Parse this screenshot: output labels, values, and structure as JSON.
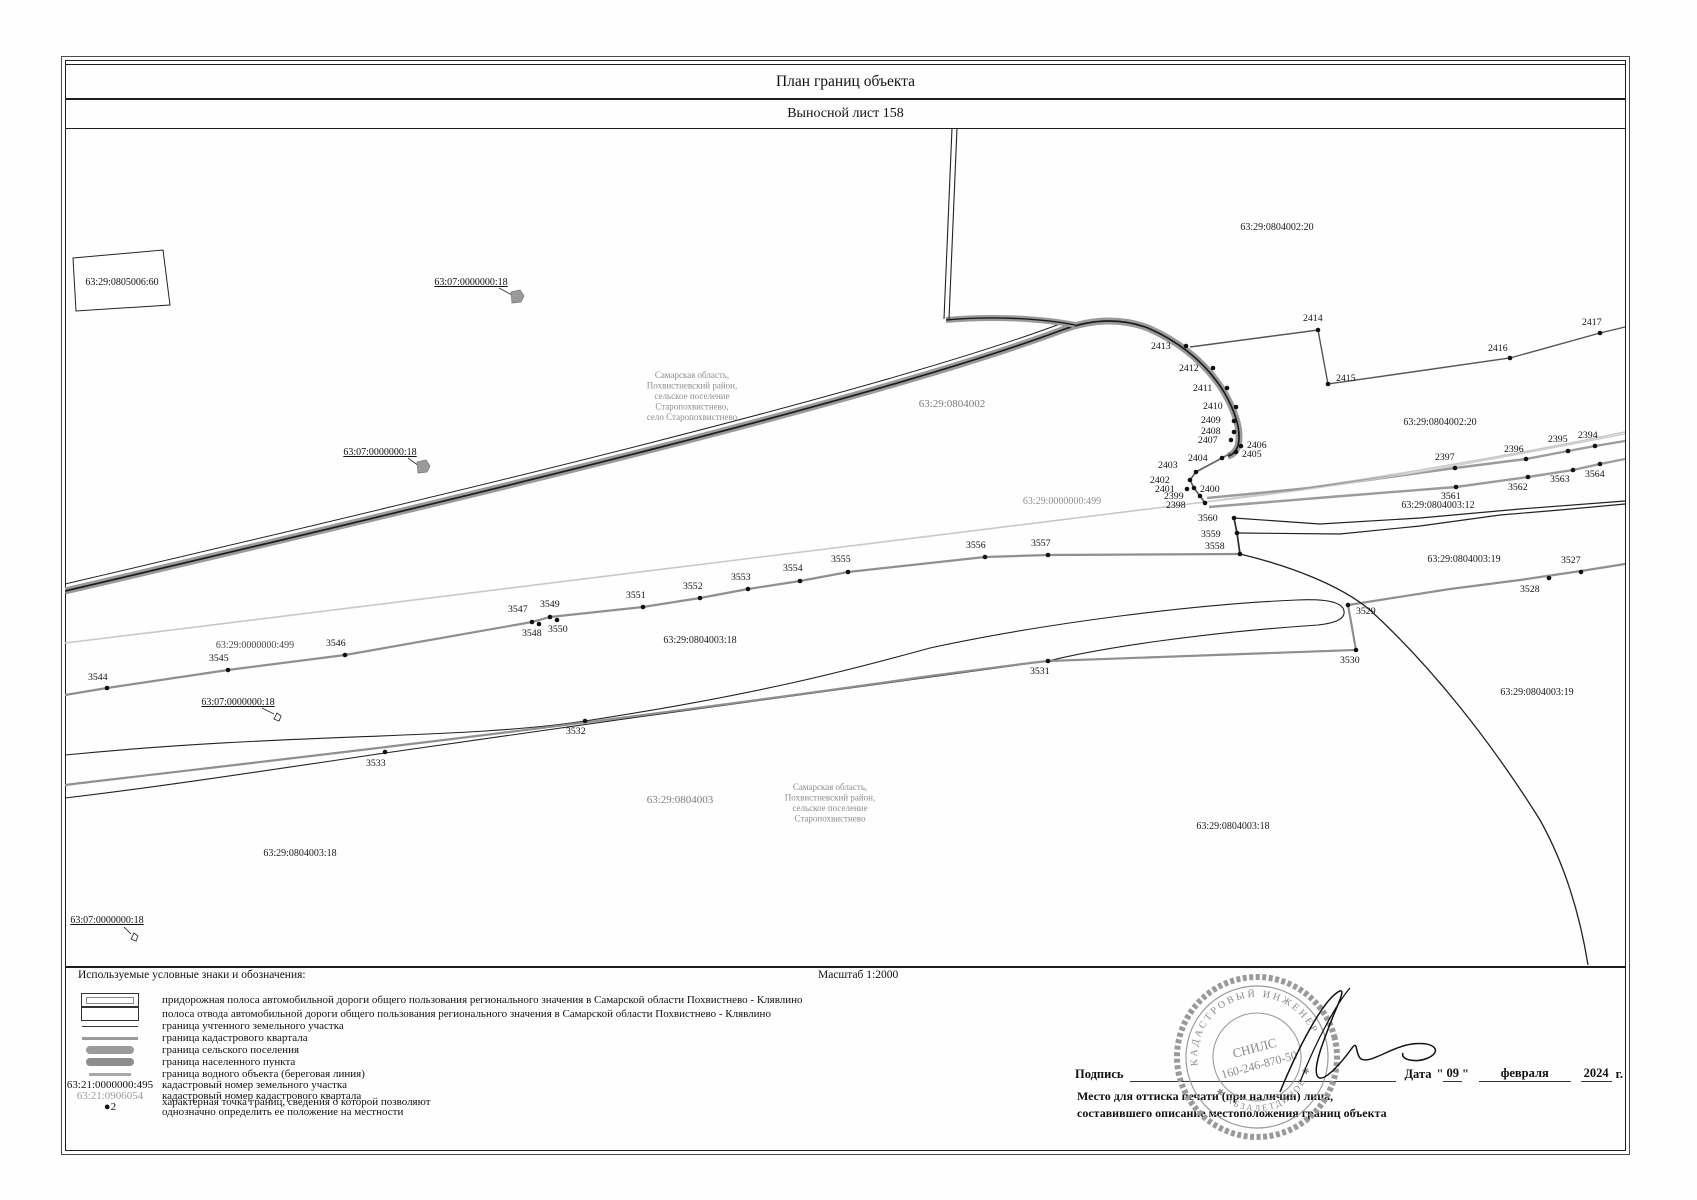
{
  "header": {
    "title": "План границ объекта",
    "subtitle": "Выносной лист 158"
  },
  "map": {
    "labels": [
      {
        "t": "63:29:0805006:60",
        "x": 122,
        "y": 285,
        "c": "#111111",
        "fs": 10
      },
      {
        "t": "63:07:0000000:18",
        "x": 471,
        "y": 285,
        "c": "#111111",
        "fs": 10,
        "ul": 1
      },
      {
        "t": "63:07:0000000:18",
        "x": 380,
        "y": 455,
        "c": "#111111",
        "fs": 10,
        "ul": 1
      },
      {
        "t": "63:07:0000000:18",
        "x": 238,
        "y": 705,
        "c": "#111111",
        "fs": 10,
        "ul": 1
      },
      {
        "t": "63:07:0000000:18",
        "x": 107,
        "y": 923,
        "c": "#111111",
        "fs": 10,
        "ul": 1
      },
      {
        "lines": [
          "Самарская область,",
          "Похвистневский район,",
          "сельское поселение",
          "Старопохвистнево,",
          "село Старопохвистнево"
        ],
        "x": 692,
        "y": 378,
        "c": "#8e8e8e",
        "fs": 9
      },
      {
        "t": "63:29:0804002",
        "x": 952,
        "y": 407,
        "c": "#7d7d7d",
        "fs": 11
      },
      {
        "t": "63:29:0804002:20",
        "x": 1277,
        "y": 230,
        "c": "#1a1a1a",
        "fs": 10
      },
      {
        "t": "63:29:0804002:20",
        "x": 1440,
        "y": 425,
        "c": "#1a1a1a",
        "fs": 10
      },
      {
        "t": "63:29:0000000:499",
        "x": 1062,
        "y": 504,
        "c": "#8e8e8e",
        "fs": 10
      },
      {
        "t": "63:29:0000000:499",
        "x": 255,
        "y": 648,
        "c": "#4a4a4a",
        "fs": 10
      },
      {
        "t": "63:29:0804003:18",
        "x": 700,
        "y": 643,
        "c": "#1a1a1a",
        "fs": 10
      },
      {
        "t": "63:29:0804003:12",
        "x": 1438,
        "y": 508,
        "c": "#1a1a1a",
        "fs": 10
      },
      {
        "t": "63:29:0804003:19",
        "x": 1464,
        "y": 562,
        "c": "#1a1a1a",
        "fs": 10
      },
      {
        "t": "63:29:0804003:19",
        "x": 1537,
        "y": 695,
        "c": "#1a1a1a",
        "fs": 10
      },
      {
        "t": "63:29:0804003",
        "x": 680,
        "y": 803,
        "c": "#7d7d7d",
        "fs": 11
      },
      {
        "lines": [
          "Самарская область,",
          "Похвистневский район,",
          "сельское поселение",
          "Старопохвистнево"
        ],
        "x": 830,
        "y": 790,
        "c": "#8e8e8e",
        "fs": 9
      },
      {
        "t": "63:29:0804003:18",
        "x": 1233,
        "y": 829,
        "c": "#1a1a1a",
        "fs": 10
      },
      {
        "t": "63:29:0804003:18",
        "x": 300,
        "y": 856,
        "c": "#1a1a1a",
        "fs": 10
      }
    ],
    "points": [
      {
        "n": "2394",
        "x": 1595,
        "y": 446,
        "lx": 1578,
        "ly": 438
      },
      {
        "n": "2395",
        "x": 1568,
        "y": 451,
        "lx": 1548,
        "ly": 442
      },
      {
        "n": "2396",
        "x": 1526,
        "y": 459,
        "lx": 1504,
        "ly": 452
      },
      {
        "n": "2397",
        "x": 1455,
        "y": 468,
        "lx": 1435,
        "ly": 460
      },
      {
        "n": "2398",
        "x": 1205,
        "y": 503,
        "lx": 1166,
        "ly": 508
      },
      {
        "n": "2399",
        "x": 1200,
        "y": 496,
        "lx": 1164,
        "ly": 499
      },
      {
        "n": "2400",
        "x": 1194,
        "y": 488,
        "lx": 1200,
        "ly": 492
      },
      {
        "n": "2401",
        "x": 1187,
        "y": 489,
        "lx": 1155,
        "ly": 492
      },
      {
        "n": "2402",
        "x": 1190,
        "y": 480,
        "lx": 1150,
        "ly": 483
      },
      {
        "n": "2403",
        "x": 1196,
        "y": 472,
        "lx": 1158,
        "ly": 468
      },
      {
        "n": "2404",
        "x": 1222,
        "y": 458,
        "lx": 1188,
        "ly": 461
      },
      {
        "n": "2405",
        "x": 1236,
        "y": 452,
        "lx": 1242,
        "ly": 457
      },
      {
        "n": "2406",
        "x": 1241,
        "y": 446,
        "lx": 1247,
        "ly": 448
      },
      {
        "n": "2407",
        "x": 1231,
        "y": 440,
        "lx": 1198,
        "ly": 443
      },
      {
        "n": "2408",
        "x": 1234,
        "y": 432,
        "lx": 1201,
        "ly": 434
      },
      {
        "n": "2409",
        "x": 1234,
        "y": 421,
        "lx": 1201,
        "ly": 423
      },
      {
        "n": "2410",
        "x": 1236,
        "y": 407,
        "lx": 1203,
        "ly": 409
      },
      {
        "n": "2411",
        "x": 1227,
        "y": 388,
        "lx": 1193,
        "ly": 391
      },
      {
        "n": "2412",
        "x": 1213,
        "y": 368,
        "lx": 1179,
        "ly": 371
      },
      {
        "n": "2413",
        "x": 1186,
        "y": 346,
        "lx": 1151,
        "ly": 349
      },
      {
        "n": "2414",
        "x": 1318,
        "y": 330,
        "lx": 1303,
        "ly": 321
      },
      {
        "n": "2415",
        "x": 1328,
        "y": 384,
        "lx": 1336,
        "ly": 381
      },
      {
        "n": "2416",
        "x": 1510,
        "y": 358,
        "lx": 1488,
        "ly": 351
      },
      {
        "n": "2417",
        "x": 1600,
        "y": 333,
        "lx": 1582,
        "ly": 325
      },
      {
        "n": "3527",
        "x": 1581,
        "y": 572,
        "lx": 1561,
        "ly": 563
      },
      {
        "n": "3528",
        "x": 1549,
        "y": 578,
        "lx": 1520,
        "ly": 592
      },
      {
        "n": "3529",
        "x": 1348,
        "y": 605,
        "lx": 1356,
        "ly": 614
      },
      {
        "n": "3530",
        "x": 1356,
        "y": 650,
        "lx": 1340,
        "ly": 663
      },
      {
        "n": "3531",
        "x": 1048,
        "y": 661,
        "lx": 1030,
        "ly": 674
      },
      {
        "n": "3532",
        "x": 585,
        "y": 721,
        "lx": 566,
        "ly": 734
      },
      {
        "n": "3533",
        "x": 385,
        "y": 752,
        "lx": 366,
        "ly": 766
      },
      {
        "n": "3544",
        "x": 107,
        "y": 688,
        "lx": 88,
        "ly": 680
      },
      {
        "n": "3545",
        "x": 228,
        "y": 670,
        "lx": 209,
        "ly": 661
      },
      {
        "n": "3546",
        "x": 345,
        "y": 655,
        "lx": 326,
        "ly": 646
      },
      {
        "n": "3547",
        "x": 532,
        "y": 622,
        "lx": 508,
        "ly": 612
      },
      {
        "n": "3548",
        "x": 539,
        "y": 624,
        "lx": 522,
        "ly": 636
      },
      {
        "n": "3549",
        "x": 550,
        "y": 617,
        "lx": 540,
        "ly": 607
      },
      {
        "n": "3550",
        "x": 557,
        "y": 620,
        "lx": 548,
        "ly": 632
      },
      {
        "n": "3551",
        "x": 643,
        "y": 607,
        "lx": 626,
        "ly": 598
      },
      {
        "n": "3552",
        "x": 700,
        "y": 598,
        "lx": 683,
        "ly": 589
      },
      {
        "n": "3553",
        "x": 748,
        "y": 589,
        "lx": 731,
        "ly": 580
      },
      {
        "n": "3554",
        "x": 800,
        "y": 581,
        "lx": 783,
        "ly": 571
      },
      {
        "n": "3555",
        "x": 848,
        "y": 572,
        "lx": 831,
        "ly": 562
      },
      {
        "n": "3556",
        "x": 985,
        "y": 557,
        "lx": 966,
        "ly": 548
      },
      {
        "n": "3557",
        "x": 1048,
        "y": 555,
        "lx": 1031,
        "ly": 546
      },
      {
        "n": "3558",
        "x": 1240,
        "y": 554,
        "lx": 1205,
        "ly": 549
      },
      {
        "n": "3559",
        "x": 1237,
        "y": 533,
        "lx": 1201,
        "ly": 537
      },
      {
        "n": "3560",
        "x": 1234,
        "y": 518,
        "lx": 1198,
        "ly": 521
      },
      {
        "n": "3561",
        "x": 1456,
        "y": 487,
        "lx": 1441,
        "ly": 499
      },
      {
        "n": "3562",
        "x": 1528,
        "y": 477,
        "lx": 1508,
        "ly": 490
      },
      {
        "n": "3563",
        "x": 1573,
        "y": 470,
        "lx": 1550,
        "ly": 482
      },
      {
        "n": "3564",
        "x": 1600,
        "y": 464,
        "lx": 1585,
        "ly": 477
      }
    ]
  },
  "legend": {
    "title": "Используемые условные знаки и обозначения:",
    "scale": "Масштаб 1:2000",
    "rows": [
      {
        "text": "придорожная полоса автомобильной дороги общего пользования регионального значения в Самарской области Похвистнево - Клявлино"
      },
      {
        "text": "полоса отвода автомобильной дороги общего пользования регионального значения в Самарской области Похвистнево - Клявлино"
      },
      {
        "text": "граница учтенного земельного участка"
      },
      {
        "text": "граница кадастрового квартала"
      },
      {
        "text": "граница сельского поселения"
      },
      {
        "text": "граница населенного пункта"
      },
      {
        "text": "граница водного объекта (береговая линия)"
      },
      {
        "text": "кадастровый номер земельного участка",
        "example": "63:21:0000000:495"
      },
      {
        "text": "кадастровый номер кадастрового квартала",
        "example": "63:21:0906054"
      },
      {
        "text": "характерная точка границ, сведения о которой позволяют",
        "text2": "однозначно определить ее положение на местности",
        "example": "●2"
      }
    ]
  },
  "footer": {
    "signature_label": "Подпись",
    "date_label": "Дата",
    "quote_open": "\"",
    "date_day": "09",
    "quote_close": "\"",
    "date_month": "февраля",
    "date_year": "2024",
    "date_suffix": "г.",
    "stamp_note_line1": "Место для оттиска печати (при наличии) лица,",
    "stamp_note_line2": "составившего описание местоположения границ объекта",
    "stamp": {
      "ring_top": "КАДАСТРОВЫЙ  ИНЖЕНЕР",
      "ring_bottom": "✱  АБЗАЛЕТДИНОВ  ✱",
      "line1": "СНИЛС",
      "line2": "160-246-870-50"
    }
  },
  "colors": {
    "settlement_boundary": "#9a9a9a",
    "quarter_boundary": "#c8c8c8",
    "parcel_boundary": "#8f8f8f",
    "stamp": "#8a8a8a"
  }
}
